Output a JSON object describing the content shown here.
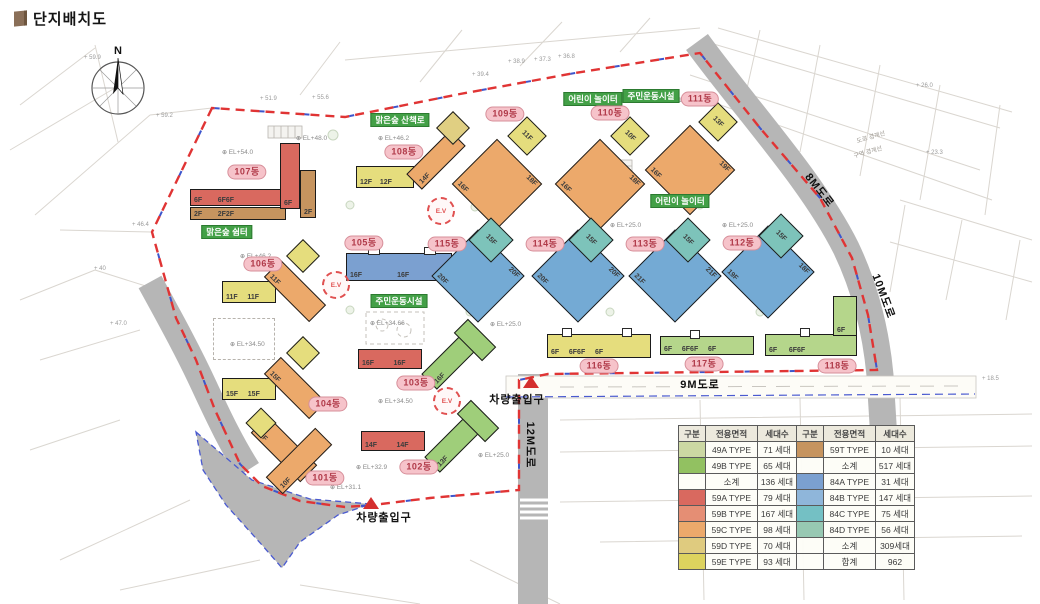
{
  "title": "단지배치도",
  "map": {
    "compass_n": "N",
    "ev": "E.V",
    "buildings": [
      {
        "label": "101동",
        "floors": [
          "10F",
          "10F"
        ]
      },
      {
        "label": "102동",
        "floors": [
          "14F          14F",
          "13F"
        ]
      },
      {
        "label": "103동",
        "floors": [
          "16F          16F",
          "16F"
        ]
      },
      {
        "label": "104동",
        "floors": [
          "15F     15F",
          "15F"
        ]
      },
      {
        "label": "105동",
        "floors": [
          "16F                  16F"
        ]
      },
      {
        "label": "106동",
        "floors": [
          "11F     11F",
          "11F"
        ]
      },
      {
        "label": "107동",
        "floors": [
          "6F        6F6F",
          "2F        2F2F",
          "6F",
          "2F"
        ]
      },
      {
        "label": "108동",
        "floors": [
          "12F    12F",
          "14F"
        ]
      },
      {
        "label": "109동",
        "floors": [
          "16F",
          "18F",
          "11F"
        ]
      },
      {
        "label": "110동",
        "floors": [
          "16F",
          "18F",
          "10F"
        ]
      },
      {
        "label": "111동",
        "floors": [
          "16F",
          "19F",
          "13F"
        ]
      },
      {
        "label": "112동",
        "floors": [
          "19F",
          "18F",
          "15F"
        ]
      },
      {
        "label": "113동",
        "floors": [
          "21F",
          "21F",
          "15F"
        ]
      },
      {
        "label": "114동",
        "floors": [
          "20F",
          "20F",
          "15F"
        ]
      },
      {
        "label": "115동",
        "floors": [
          "20F",
          "20F",
          "15F"
        ]
      },
      {
        "label": "116동",
        "floors": [
          "6F     6F6F     6F"
        ]
      },
      {
        "label": "117동",
        "floors": [
          "6F     6F6F     6F"
        ]
      },
      {
        "label": "118동",
        "floors": [
          "6F      6F6F",
          "6F"
        ]
      }
    ],
    "facilities": [
      "맑은숲 산책로",
      "어린이 놀이터",
      "주민운동시설",
      "어린이 놀이터",
      "맑은숲 쉼터",
      "주민운동시설"
    ],
    "roads": [
      "8M도로",
      "10M도로",
      "9M도로",
      "12M도로"
    ],
    "entrance": "차량출입구",
    "elevations": [
      "EL+54.0",
      "EL+48.0",
      "EL+46.2",
      "EL+31.3",
      "EL+25.0",
      "EL+25.0",
      "EL+25.0",
      "EL+34.50",
      "EL+34.66",
      "EL+34.50",
      "EL+32.9",
      "EL+31.1",
      "EL+25.0",
      "EL+46.2"
    ],
    "survey_marks": [
      "59.9",
      "59.2",
      "51.9",
      "55.6",
      "46.4",
      "47.0",
      "40",
      "38.9",
      "37.3",
      "36.8",
      "39.4",
      "26.0",
      "23.3",
      "18.5"
    ],
    "boundary_notes": [
      "도로 경계선",
      "구역 경계선"
    ]
  },
  "legend": {
    "headers": [
      "구분",
      "전용면적",
      "세대수",
      "구분",
      "전용면적",
      "세대수"
    ],
    "rows": [
      {
        "lc": "#ccd8a3",
        "lt": "49A TYPE",
        "ln": "71 세대",
        "rc": "#c6945f",
        "rt": "59T TYPE",
        "rn": "10 세대"
      },
      {
        "lc": "#92c161",
        "lt": "49B TYPE",
        "ln": "65 세대",
        "rc": "",
        "rt": "소계",
        "rn": "517 세대"
      },
      {
        "lc": "",
        "lt": "소계",
        "ln": "136 세대",
        "rc": "#7ba0d0",
        "rt": "84A TYPE",
        "rn": "31 세대"
      },
      {
        "lc": "#d9695f",
        "lt": "59A TYPE",
        "ln": "79 세대",
        "rc": "#8fb6da",
        "rt": "84B TYPE",
        "rn": "147 세대"
      },
      {
        "lc": "#e58e74",
        "lt": "59B TYPE",
        "ln": "167 세대",
        "rc": "#74c0c4",
        "rt": "84C TYPE",
        "rn": "75 세대"
      },
      {
        "lc": "#eca96b",
        "lt": "59C TYPE",
        "ln": "98 세대",
        "rc": "#97c8b2",
        "rt": "84D TYPE",
        "rn": "56 세대"
      },
      {
        "lc": "#dfcb7f",
        "lt": "59D TYPE",
        "ln": "70 세대",
        "rc": "",
        "rt": "소계",
        "rn": "309세대"
      },
      {
        "lc": "#ddd35e",
        "lt": "59E TYPE",
        "ln": "93 세대",
        "rc": "",
        "rt": "합계",
        "rn": "962"
      }
    ]
  },
  "colors": {
    "boundary_red": "#e03434",
    "boundary_blue": "#3d55cc",
    "road_gray": "#b6b6b6",
    "badge_pink": "#f6c3ca",
    "facility_green": "#43a047"
  }
}
